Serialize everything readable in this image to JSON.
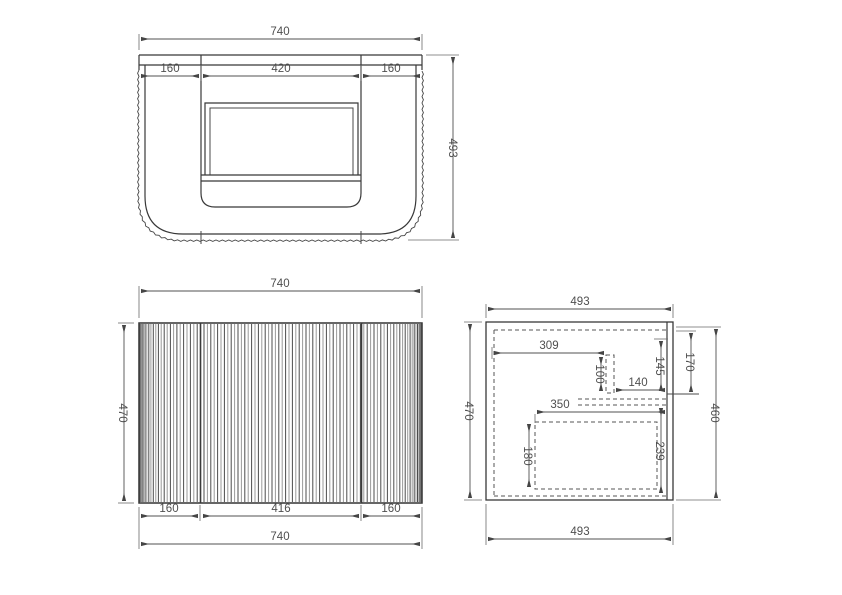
{
  "drawing": {
    "type": "technical-drawing",
    "subject": "curved-fluted-wall-hung-vanity",
    "background": "#ffffff",
    "line_color": "#383838",
    "dim_text_color": "#4f4f4f",
    "views": {
      "top": {
        "label": "plan-view",
        "overall_width": "740",
        "left_section": "160",
        "center_section": "420",
        "right_section": "160",
        "overall_depth": "493"
      },
      "front": {
        "label": "front-view",
        "overall_width_top": "740",
        "overall_height": "470",
        "bottom_left_section": "160",
        "bottom_center_section": "416",
        "bottom_right_section": "160",
        "overall_width_bottom": "740"
      },
      "side": {
        "label": "side-section-view",
        "overall_depth_top": "493",
        "overall_height_left": "470",
        "cabinet_height_right": "460",
        "overall_depth_bottom": "493",
        "bracket_offset": "309",
        "bracket_height": "100",
        "bracket_to_back": "140",
        "rail_height": "145",
        "top_clearance": "170",
        "drawer_depth": "350",
        "drawer_height": "180",
        "lower_back_height": "239"
      }
    }
  }
}
